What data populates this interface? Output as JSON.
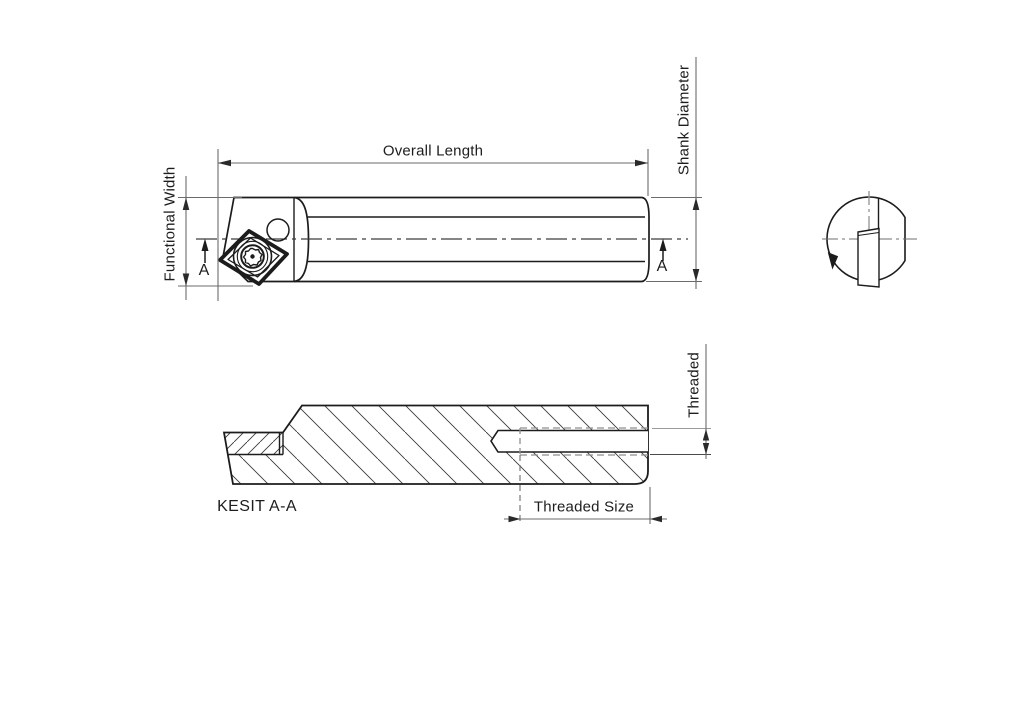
{
  "drawing": {
    "type": "technical-engineering-drawing",
    "subject": "boring bar / indexable turning tool with insert, end view and section view",
    "labels": {
      "overall_length": "Overall Length",
      "shank_diameter": "Shank Diameter",
      "functional_width": "Functional Width",
      "threaded": "Threaded",
      "threaded_size": "Threaded Size",
      "section_title": "KESIT A-A",
      "section_marker": "A"
    },
    "colors": {
      "outline": "#1c1c1c",
      "dimension": "#6b6b6b",
      "arrow": "#2a2a2a",
      "hatch": "#3a3a3a",
      "thread_dashed": "#8f8f8f",
      "background": "#ffffff"
    }
  }
}
